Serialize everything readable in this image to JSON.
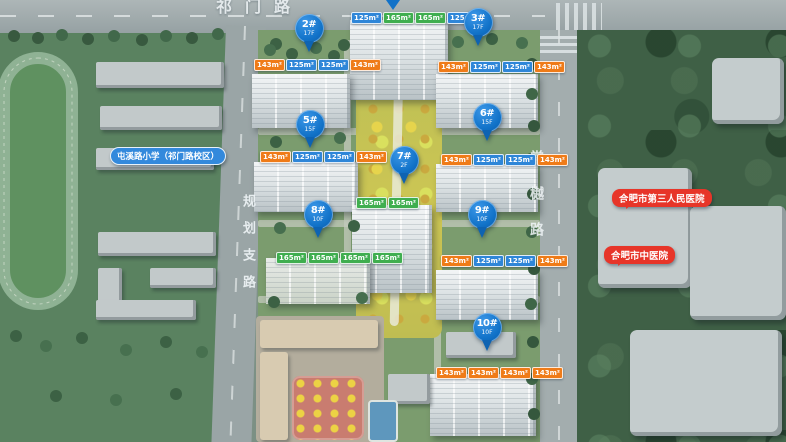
{
  "map": {
    "roads": {
      "top": "祁门路",
      "left": "规划支路",
      "right": "棠樾路"
    },
    "pois": {
      "school": {
        "label": "屯溪路小学（祁门路校区）",
        "color": "#3389dc"
      },
      "hospital_1": {
        "label": "合肥市第三人民医院",
        "color": "#e73529"
      },
      "hospital_2": {
        "label": "合肥市中医院",
        "color": "#e73529"
      }
    },
    "pin_color": "#1172c8",
    "unit_colors": {
      "125": "#2e86d8",
      "143": "#ef7b18",
      "165": "#3fae4f"
    },
    "buildings": [
      {
        "id": "1#",
        "units": [
          "125m²",
          "165m²",
          "165m²",
          "125m²"
        ]
      },
      {
        "id": "2#",
        "pin": {
          "no": "2#",
          "floors": "17F"
        },
        "units": [
          "143m²",
          "125m²",
          "125m²",
          "143m²"
        ]
      },
      {
        "id": "3#",
        "pin": {
          "no": "3#",
          "floors": "17F"
        },
        "units": [
          "143m²",
          "125m²",
          "125m²",
          "143m²"
        ]
      },
      {
        "id": "5#",
        "pin": {
          "no": "5#",
          "floors": "15F"
        },
        "units": [
          "143m²",
          "125m²",
          "125m²",
          "143m²"
        ]
      },
      {
        "id": "6#",
        "pin": {
          "no": "6#",
          "floors": "15F"
        },
        "units": [
          "143m²",
          "125m²",
          "125m²",
          "143m²"
        ]
      },
      {
        "id": "7#",
        "pin": {
          "no": "7#",
          "floors": "2F"
        },
        "units": [
          "165m²",
          "165m²"
        ]
      },
      {
        "id": "8#",
        "pin": {
          "no": "8#",
          "floors": "10F"
        },
        "units": [
          "165m²",
          "165m²",
          "165m²",
          "165m²"
        ]
      },
      {
        "id": "9#",
        "pin": {
          "no": "9#",
          "floors": "10F"
        },
        "units": [
          "143m²",
          "125m²",
          "125m²",
          "143m²"
        ]
      },
      {
        "id": "10#",
        "pin": {
          "no": "10#",
          "floors": "10F"
        },
        "units": [
          "143m²",
          "143m²",
          "143m²",
          "143m²"
        ]
      }
    ]
  }
}
